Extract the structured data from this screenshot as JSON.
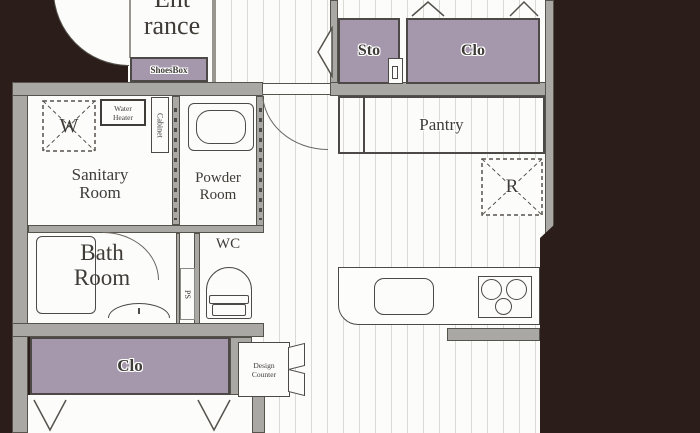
{
  "plan": {
    "rooms": {
      "entrance": {
        "line1": "Ent",
        "line2": "rance"
      },
      "shoes_box": "ShoesBox",
      "sto": "Sto",
      "clo_upper": "Clo",
      "pantry": "Pantry",
      "refrigerator": "R",
      "washer": "W",
      "water_heater": {
        "line1": "Water",
        "line2": "Heater"
      },
      "cabinet": "Cabinet",
      "sanitary": {
        "line1": "Sanitary",
        "line2": "Room"
      },
      "powder": {
        "line1": "Powder",
        "line2": "Room"
      },
      "bath": {
        "line1": "Bath",
        "line2": "Room"
      },
      "wc": "WC",
      "ps": "PS",
      "clo_lower": "Clo",
      "design_counter": {
        "line1": "Design",
        "line2": "Counter"
      }
    },
    "colors": {
      "background": "#2b1d19",
      "wall": "#a9a8a4",
      "wall_edge": "#56534d",
      "closet": "#a698ac",
      "floor": "#fcfcfa",
      "floor_line": "#d9d9d5",
      "text": "#3f3c38"
    }
  }
}
